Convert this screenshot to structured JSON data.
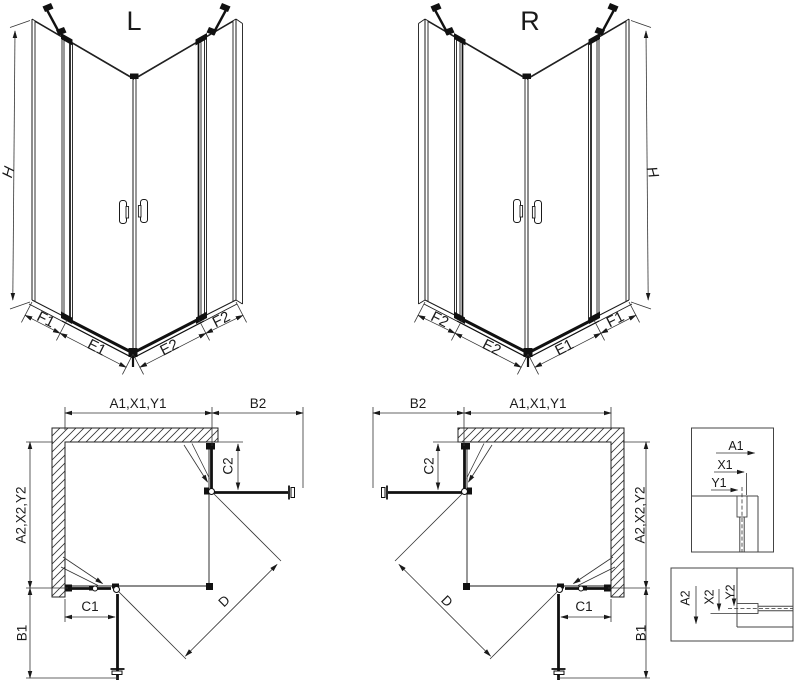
{
  "iso_left": {
    "title": "L",
    "height_label": "H",
    "bottom_labels": [
      "F1",
      "E1",
      "E2",
      "F2"
    ]
  },
  "iso_right": {
    "title": "R",
    "height_label": "H",
    "bottom_labels": [
      "F2",
      "E2",
      "E1",
      "F1"
    ]
  },
  "plan_left": {
    "top_width_label": "A1,X1,Y1",
    "top_offset_label": "B2",
    "side_height_label": "A2,X2,Y2",
    "side_offset_label": "B1",
    "fixed_right_label": "C2",
    "fixed_bottom_label": "C1",
    "diagonal_label": "D"
  },
  "plan_right": {
    "top_width_label": "A1,X1,Y1",
    "top_offset_label": "B2",
    "side_height_label": "A2,X2,Y2",
    "side_offset_label": "B1",
    "fixed_right_label": "C2",
    "fixed_bottom_label": "C1",
    "diagonal_label": "D"
  },
  "detail_top": {
    "labels": [
      "A1",
      "X1",
      "Y1"
    ]
  },
  "detail_bottom": {
    "labels": [
      "A2",
      "X2",
      "Y2"
    ]
  },
  "colors": {
    "line": "#1a1a1a",
    "accent": "#111111",
    "wall_hatch": "#333333"
  }
}
